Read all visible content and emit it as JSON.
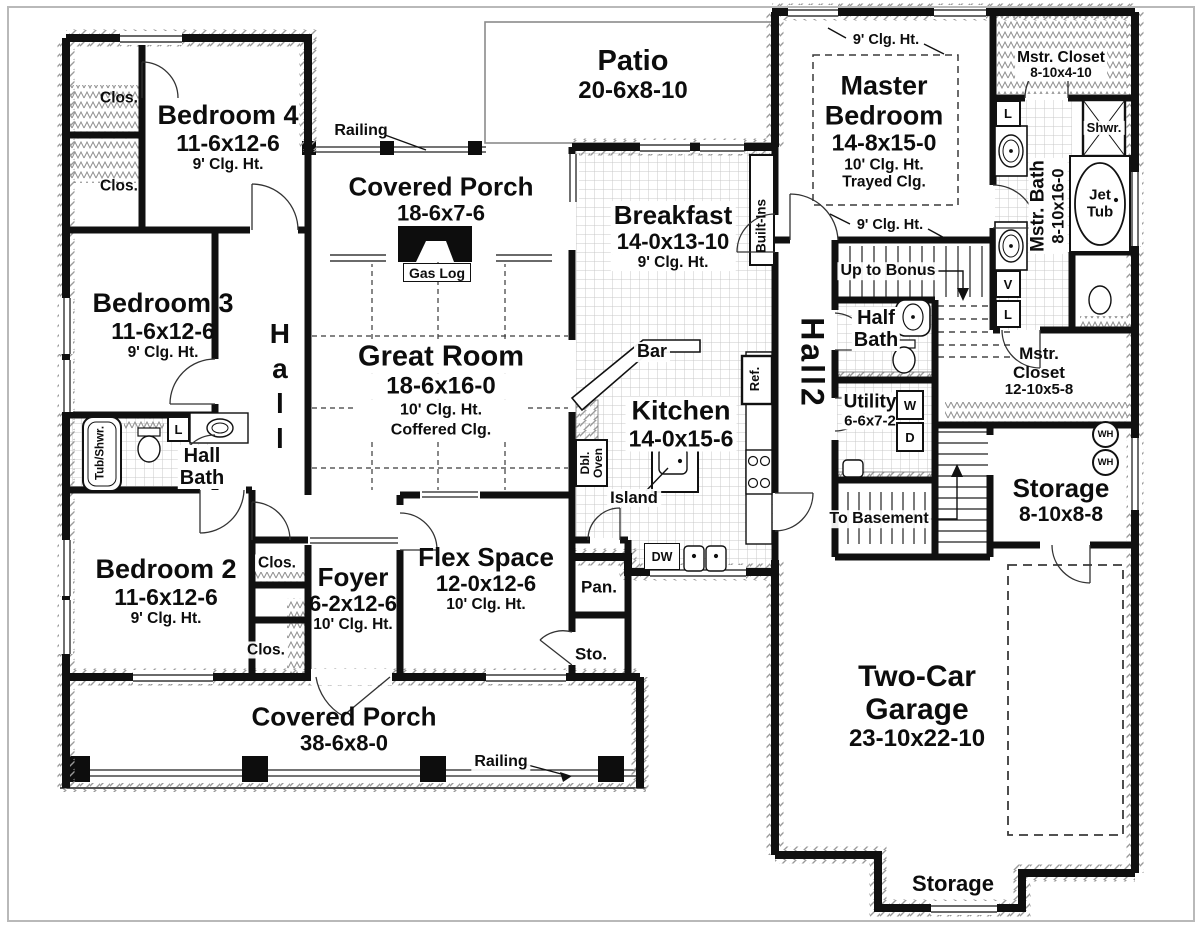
{
  "colors": {
    "wall": "#101010",
    "tile_line": "#c8c8c8",
    "hatch_line": "#9a9a9a"
  },
  "rooms": {
    "bedroom4": {
      "name": "Bedroom 4",
      "dims": "11-6x12-6",
      "ceiling": "9' Clg. Ht."
    },
    "bedroom3": {
      "name": "Bedroom 3",
      "dims": "11-6x12-6",
      "ceiling": "9' Clg. Ht."
    },
    "bedroom2": {
      "name": "Bedroom 2",
      "dims": "11-6x12-6",
      "ceiling": "9' Clg. Ht."
    },
    "master_bedroom": {
      "line1": "Master",
      "line2": "Bedroom",
      "dims": "14-8x15-0",
      "ceiling": "10' Clg. Ht.",
      "ceiling2": "Trayed Clg.",
      "note": "9' Clg. Ht."
    },
    "great_room": {
      "name": "Great Room",
      "dims": "18-6x16-0",
      "ceiling": "10' Clg. Ht.",
      "ceiling2": "Coffered Clg."
    },
    "kitchen": {
      "name": "Kitchen",
      "dims": "14-0x15-6"
    },
    "breakfast": {
      "name": "Breakfast",
      "dims": "14-0x13-10",
      "ceiling": "9' Clg. Ht."
    },
    "flex_space": {
      "name": "Flex Space",
      "dims": "12-0x12-6",
      "ceiling": "10' Clg. Ht."
    },
    "foyer": {
      "name": "Foyer",
      "dims": "6-2x12-6",
      "ceiling": "10' Clg. Ht."
    },
    "front_porch": {
      "name": "Covered Porch",
      "dims": "38-6x8-0"
    },
    "rear_porch": {
      "name": "Covered Porch",
      "dims": "18-6x7-6"
    },
    "patio": {
      "name": "Patio",
      "dims": "20-6x8-10"
    },
    "garage": {
      "line1": "Two-Car",
      "line2": "Garage",
      "dims": "23-10x22-10"
    },
    "master_closet_top": {
      "name": "Mstr. Closet",
      "dims": "8-10x4-10"
    },
    "master_closet_side": {
      "line1": "Mstr.",
      "line2": "Closet",
      "dims": "12-10x5-8"
    },
    "master_bath": {
      "name": "Mstr. Bath",
      "dims": "8-10x16-0"
    },
    "half_bath": {
      "line1": "Half",
      "line2": "Bath"
    },
    "hall_bath": {
      "line1": "Hall",
      "line2": "Bath"
    },
    "utility": {
      "name": "Utility",
      "dims": "6-6x7-2"
    },
    "storage_side": {
      "name": "Storage",
      "dims": "8-10x8-8"
    },
    "storage_rear": {
      "name": "Storage"
    },
    "hall": {
      "name": "Hall"
    },
    "hall2": {
      "name": "Hall2"
    }
  },
  "labels": {
    "closet": "Clos.",
    "railing": "Railing",
    "gas_log": "Gas Log",
    "built_ins": "Built-Ins",
    "bar": "Bar",
    "island": "Island",
    "fridge": "Ref.",
    "dbl_oven_line1": "Dbl.",
    "dbl_oven_line2": "Oven",
    "dishwasher": "DW",
    "pantry": "Pan.",
    "storage_closet": "Sto.",
    "tub_shower": "Tub/Shwr.",
    "shower": "Shwr.",
    "jet_tub_line1": "Jet",
    "jet_tub_line2": "Tub",
    "up_to_bonus": "Up to Bonus",
    "to_basement": "To Basement",
    "washer": "W",
    "dryer": "D",
    "water_heater": "WH",
    "linen": "L",
    "vanity": "V"
  }
}
